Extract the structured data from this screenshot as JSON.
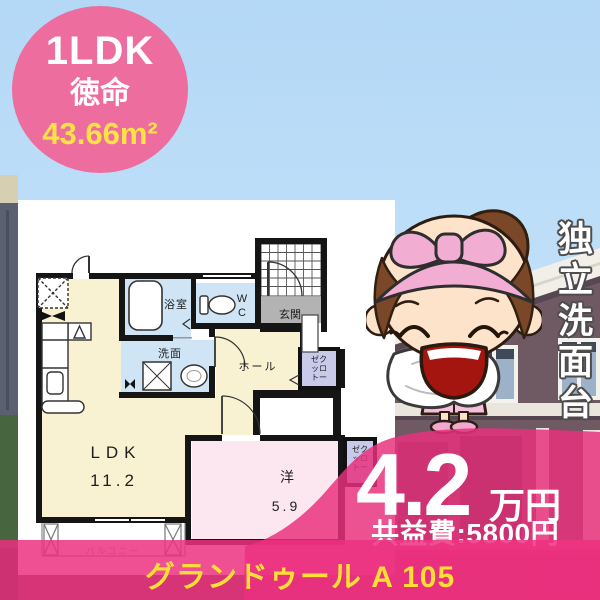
{
  "listing": {
    "layout_type": "1LDK",
    "location": "徳命",
    "area": "43.66m²",
    "feature_vertical": "独立洗面台",
    "rent_value": "4.2",
    "rent_unit": "万円",
    "common_fee": "共益費:5800円",
    "property_name": "グランドゥール A 105"
  },
  "floor_plan": {
    "ldk_label": "LDK",
    "ldk_size": "11.2",
    "bedroom_label": "洋",
    "bedroom_size": "5.9",
    "bath": "浴室",
    "washroom": "洗面",
    "wc_line1": "W",
    "wc_line2": "C",
    "entrance": "玄関",
    "hall": "ホール",
    "closet_row1": "ゼク",
    "closet_row2": "ッロ",
    "closet_row3": "トー",
    "closet2_row1": "ゼク",
    "closet2_row2": "ッロ",
    "closet2_row3": "トー",
    "balcony": "バルコニー"
  },
  "colors": {
    "badge_pink": "#ee6d9f",
    "price_panel_pink": "#e8317c",
    "banner_pink": "#ec3080",
    "accent_yellow": "#ffe345",
    "banner_text_yellow": "#ffdf35",
    "plan_cream": "#f9f2d2",
    "plan_blue": "#cfe4f4",
    "plan_room_pink": "#fce7f1",
    "plan_gray": "#b3b3b3",
    "plan_lavender": "#c9c9ea",
    "sky_blue": "#bcdef8"
  }
}
